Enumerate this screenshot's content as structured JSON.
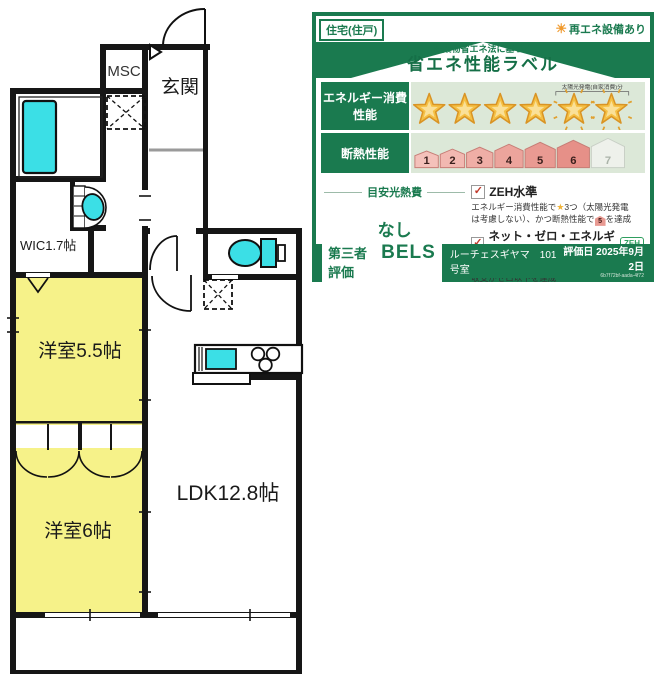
{
  "floor_plan": {
    "labels": {
      "msc": "MSC",
      "genkan": "玄関",
      "wic": "WIC1.7帖",
      "bedroom_55": "洋室5.5帖",
      "bedroom_6": "洋室6帖",
      "ldk": "LDK12.8帖"
    },
    "colors": {
      "room_yellow": "#f6f289",
      "fixture_cyan": "#3bdfe6",
      "wall_black": "#161616"
    }
  },
  "energy_label": {
    "badge_left": "住宅(住戸)",
    "badge_right": "再エネ設備あり",
    "subtitle": "建築物省エネ法に基づく",
    "title": "省エネ性能ラベル",
    "energy_row": {
      "label": "エネルギー消費性能",
      "stars_total": 6,
      "stars_filled": 6,
      "solar_stars": 2,
      "solar_caption": "太陽光発電(自家消費)分"
    },
    "insulation_row": {
      "label": "断熱性能",
      "levels": [
        "1",
        "2",
        "3",
        "4",
        "5",
        "6",
        "7"
      ],
      "colored_levels": 6
    },
    "utility": {
      "header": "目安光熱費",
      "value": "なし"
    },
    "checks": {
      "check_glyph": "✓",
      "zeh_label": "ZEH水準",
      "zeh_desc_1": "エネルギー消費性能で",
      "zeh_desc_star": "★",
      "zeh_desc_2": "3つ（太陽光発電",
      "zeh_desc_3": "は考慮しない）、かつ断熱性能で",
      "zeh_desc_house": "5",
      "zeh_desc_4": "を達成",
      "nze_label": "ネット・ゼロ・エネルギー",
      "nze_icon": "ZEH",
      "nze_desc_1": "太陽光発電の売電分も含めてエネルギー",
      "nze_desc_2": "収支がゼロ以下を達成"
    },
    "footer": {
      "cert_type": "第三者評価",
      "cert_name": "BELS",
      "building": "ルーチェスギヤマ　101号室",
      "eval_date": "評価日 2025年9月2日",
      "eval_id": "6b7f72bf-aada-4f72"
    },
    "colors": {
      "green": "#1a7a4f",
      "row_bg": "#dce8d8",
      "star_gold": "#f5c044",
      "house_pink": "#eba6a0"
    }
  }
}
